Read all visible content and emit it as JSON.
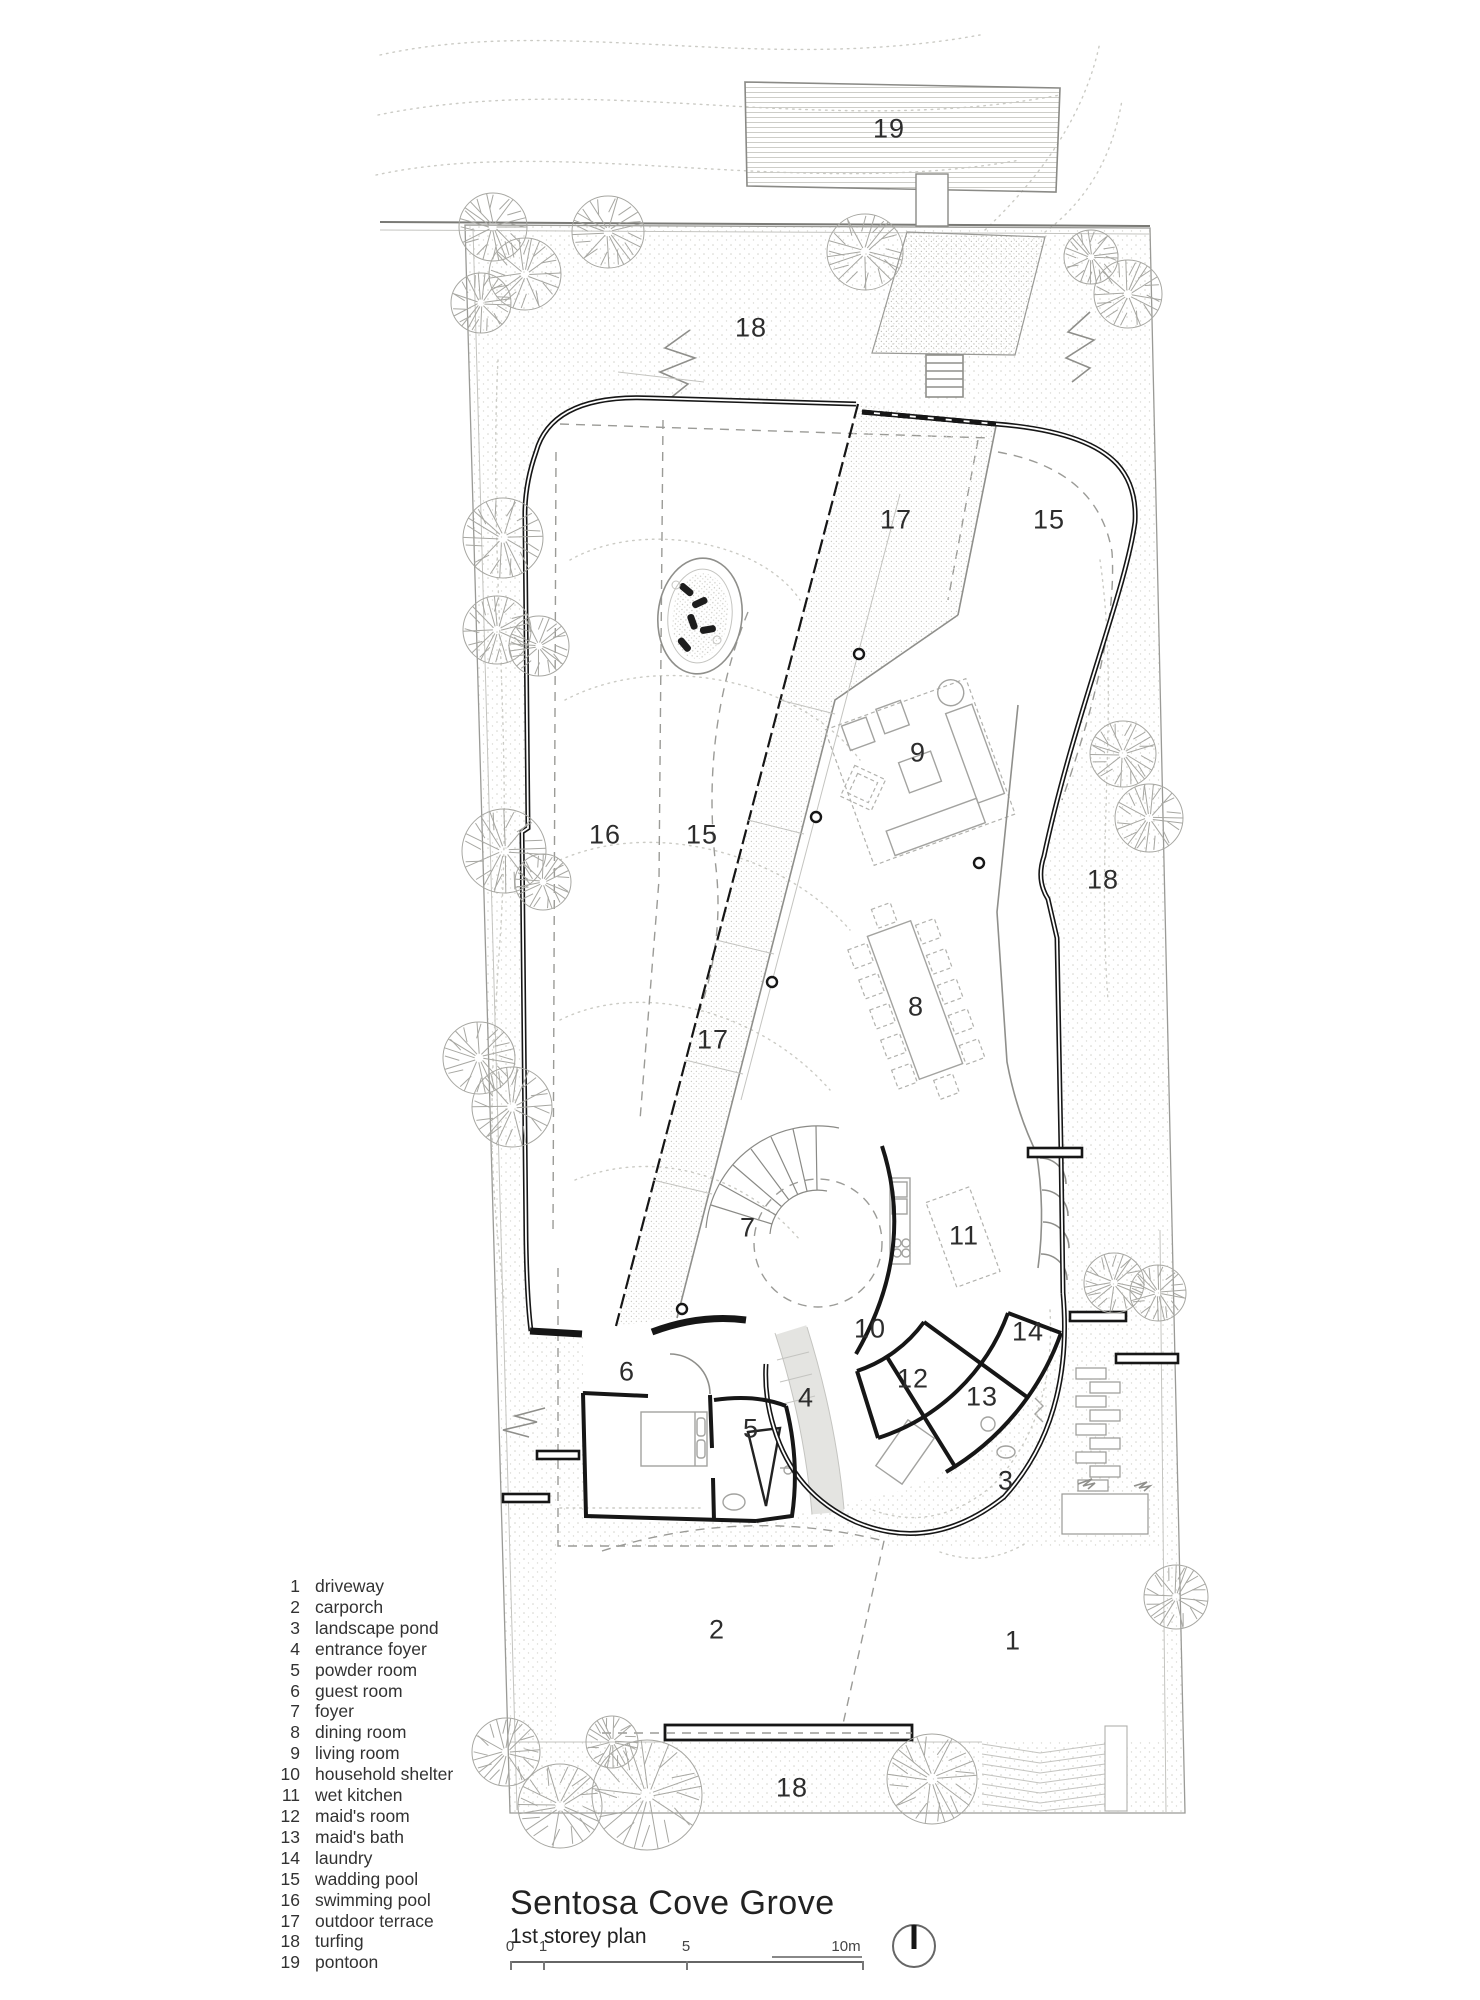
{
  "title_block": {
    "title": "Sentosa Cove Grove",
    "subtitle": "1st storey plan"
  },
  "scale_bar": {
    "unit_note": "10m",
    "ticks": [
      {
        "label": "0",
        "label_x": 510,
        "tick_x": 510
      },
      {
        "label": "1",
        "label_x": 543,
        "tick_x": 543
      },
      {
        "label": "5",
        "label_x": 686,
        "tick_x": 686
      },
      {
        "label": "10m",
        "label_x": 846,
        "tick_x": 862
      }
    ]
  },
  "legend": {
    "items": [
      {
        "num": "1",
        "label": "driveway"
      },
      {
        "num": "2",
        "label": "carporch"
      },
      {
        "num": "3",
        "label": "landscape pond"
      },
      {
        "num": "4",
        "label": "entrance foyer"
      },
      {
        "num": "5",
        "label": "powder room"
      },
      {
        "num": "6",
        "label": "guest room"
      },
      {
        "num": "7",
        "label": "foyer"
      },
      {
        "num": "8",
        "label": "dining room"
      },
      {
        "num": "9",
        "label": "living room"
      },
      {
        "num": "10",
        "label": "household shelter"
      },
      {
        "num": "11",
        "label": "wet kitchen"
      },
      {
        "num": "12",
        "label": "maid's room"
      },
      {
        "num": "13",
        "label": "maid's bath"
      },
      {
        "num": "14",
        "label": "laundry"
      },
      {
        "num": "15",
        "label": "wadding pool"
      },
      {
        "num": "16",
        "label": "swimming pool"
      },
      {
        "num": "17",
        "label": "outdoor terrace"
      },
      {
        "num": "18",
        "label": "turfing"
      },
      {
        "num": "19",
        "label": "pontoon"
      }
    ]
  },
  "plan_labels": [
    {
      "num": "19",
      "x": 889,
      "y": 129
    },
    {
      "num": "18",
      "x": 751,
      "y": 328
    },
    {
      "num": "17",
      "x": 896,
      "y": 520
    },
    {
      "num": "15",
      "x": 1049,
      "y": 520
    },
    {
      "num": "16",
      "x": 605,
      "y": 835
    },
    {
      "num": "15",
      "x": 702,
      "y": 835
    },
    {
      "num": "9",
      "x": 918,
      "y": 753
    },
    {
      "num": "18",
      "x": 1103,
      "y": 880
    },
    {
      "num": "8",
      "x": 916,
      "y": 1007
    },
    {
      "num": "17",
      "x": 713,
      "y": 1040
    },
    {
      "num": "7",
      "x": 748,
      "y": 1228
    },
    {
      "num": "11",
      "x": 964,
      "y": 1236
    },
    {
      "num": "10",
      "x": 870,
      "y": 1329
    },
    {
      "num": "14",
      "x": 1028,
      "y": 1332
    },
    {
      "num": "6",
      "x": 627,
      "y": 1372
    },
    {
      "num": "12",
      "x": 913,
      "y": 1379
    },
    {
      "num": "13",
      "x": 982,
      "y": 1397
    },
    {
      "num": "4",
      "x": 806,
      "y": 1398
    },
    {
      "num": "5",
      "x": 751,
      "y": 1429
    },
    {
      "num": "3",
      "x": 1006,
      "y": 1481
    },
    {
      "num": "2",
      "x": 717,
      "y": 1630
    },
    {
      "num": "1",
      "x": 1013,
      "y": 1641
    },
    {
      "num": "18",
      "x": 792,
      "y": 1788
    }
  ],
  "site": {
    "trees": [
      {
        "x": 493,
        "y": 227,
        "r": 34
      },
      {
        "x": 525,
        "y": 274,
        "r": 36
      },
      {
        "x": 608,
        "y": 232,
        "r": 36
      },
      {
        "x": 481,
        "y": 303,
        "r": 30
      },
      {
        "x": 865,
        "y": 252,
        "r": 38
      },
      {
        "x": 1091,
        "y": 257,
        "r": 27
      },
      {
        "x": 1128,
        "y": 294,
        "r": 34
      },
      {
        "x": 503,
        "y": 538,
        "r": 40
      },
      {
        "x": 497,
        "y": 630,
        "r": 34
      },
      {
        "x": 539,
        "y": 646,
        "r": 30
      },
      {
        "x": 504,
        "y": 851,
        "r": 42
      },
      {
        "x": 543,
        "y": 882,
        "r": 28
      },
      {
        "x": 479,
        "y": 1058,
        "r": 36
      },
      {
        "x": 512,
        "y": 1107,
        "r": 40
      },
      {
        "x": 1123,
        "y": 754,
        "r": 33
      },
      {
        "x": 1149,
        "y": 818,
        "r": 34
      },
      {
        "x": 1114,
        "y": 1283,
        "r": 30
      },
      {
        "x": 1158,
        "y": 1293,
        "r": 28
      },
      {
        "x": 1176,
        "y": 1597,
        "r": 32
      },
      {
        "x": 932,
        "y": 1779,
        "r": 45
      },
      {
        "x": 647,
        "y": 1795,
        "r": 55
      },
      {
        "x": 560,
        "y": 1806,
        "r": 42
      },
      {
        "x": 612,
        "y": 1742,
        "r": 26
      },
      {
        "x": 506,
        "y": 1752,
        "r": 34
      }
    ]
  }
}
